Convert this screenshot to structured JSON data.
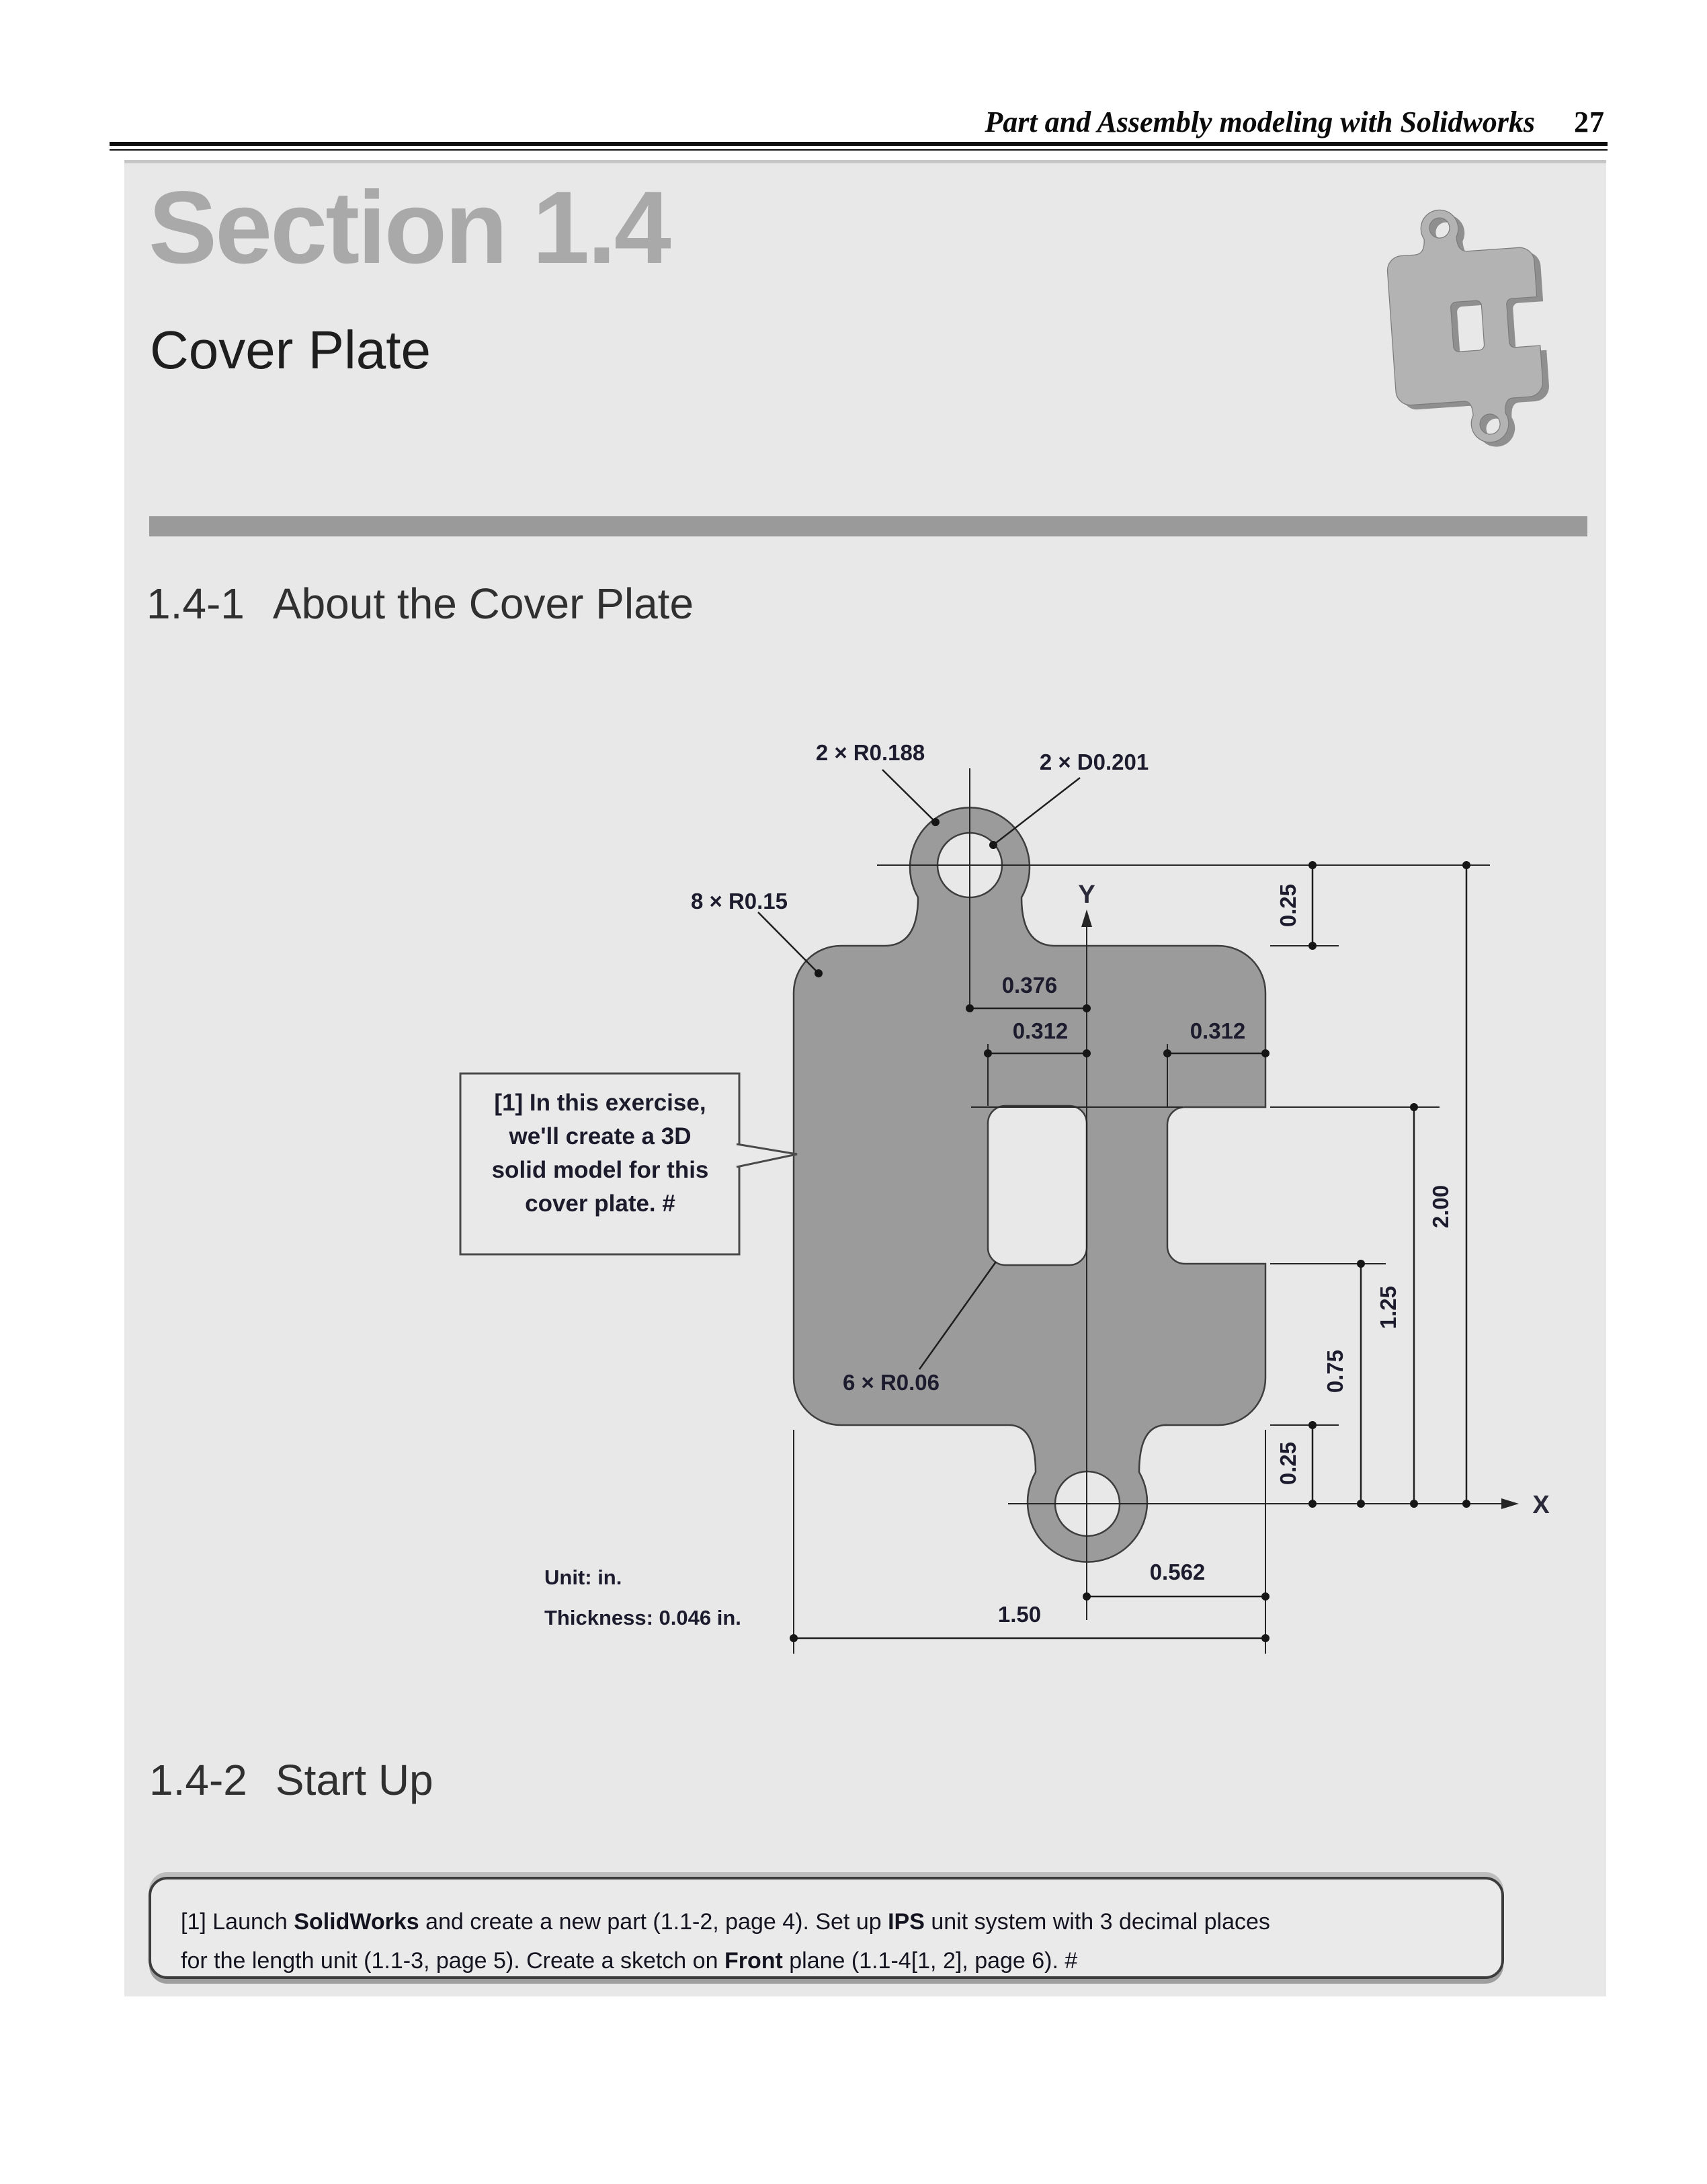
{
  "header": {
    "book_title": "Part and Assembly modeling with Solidworks",
    "page_number": "27"
  },
  "section": {
    "title": "Section 1.4",
    "subtitle": "Cover Plate"
  },
  "about": {
    "number": "1.4-1",
    "title": "About the Cover Plate"
  },
  "startup": {
    "number": "1.4-2",
    "title": "Start Up"
  },
  "drawing": {
    "labels": {
      "tab_radius": "2 × R0.188",
      "hole_diameter": "2 × D0.201",
      "corner_radius": "8 × R0.15",
      "fillet_radius": "6 × R0.06"
    },
    "dims": {
      "tab_offset": "0.376",
      "slot_offset": "0.312",
      "notch_width": "0.312",
      "top_margin": "0.25",
      "total_height": "2.00",
      "notch_top": "1.25",
      "notch_bottom": "0.75",
      "bottom_margin": "0.25",
      "hole_offset": "0.562",
      "total_width": "1.50"
    },
    "axes": {
      "x": "X",
      "y": "Y"
    },
    "callout": {
      "line1": "[1] In this exercise,",
      "line2": "we'll create a 3D",
      "line3": "solid model for this",
      "line4": "cover plate. #"
    },
    "notes": {
      "unit": "Unit: in.",
      "thickness": "Thickness: 0.046 in."
    }
  },
  "startup_box": {
    "p1": "[1] Launch ",
    "b1": "SolidWorks",
    "p2": " and create a new part (1.1-2, page 4).  Set up ",
    "b2": "IPS",
    "p3": " unit system with 3 decimal places",
    "p4": "for the length unit (1.1-3, page 5).  Create a sketch on ",
    "b3": "Front",
    "p5": " plane (1.1-4[1, 2], page 6). #"
  }
}
